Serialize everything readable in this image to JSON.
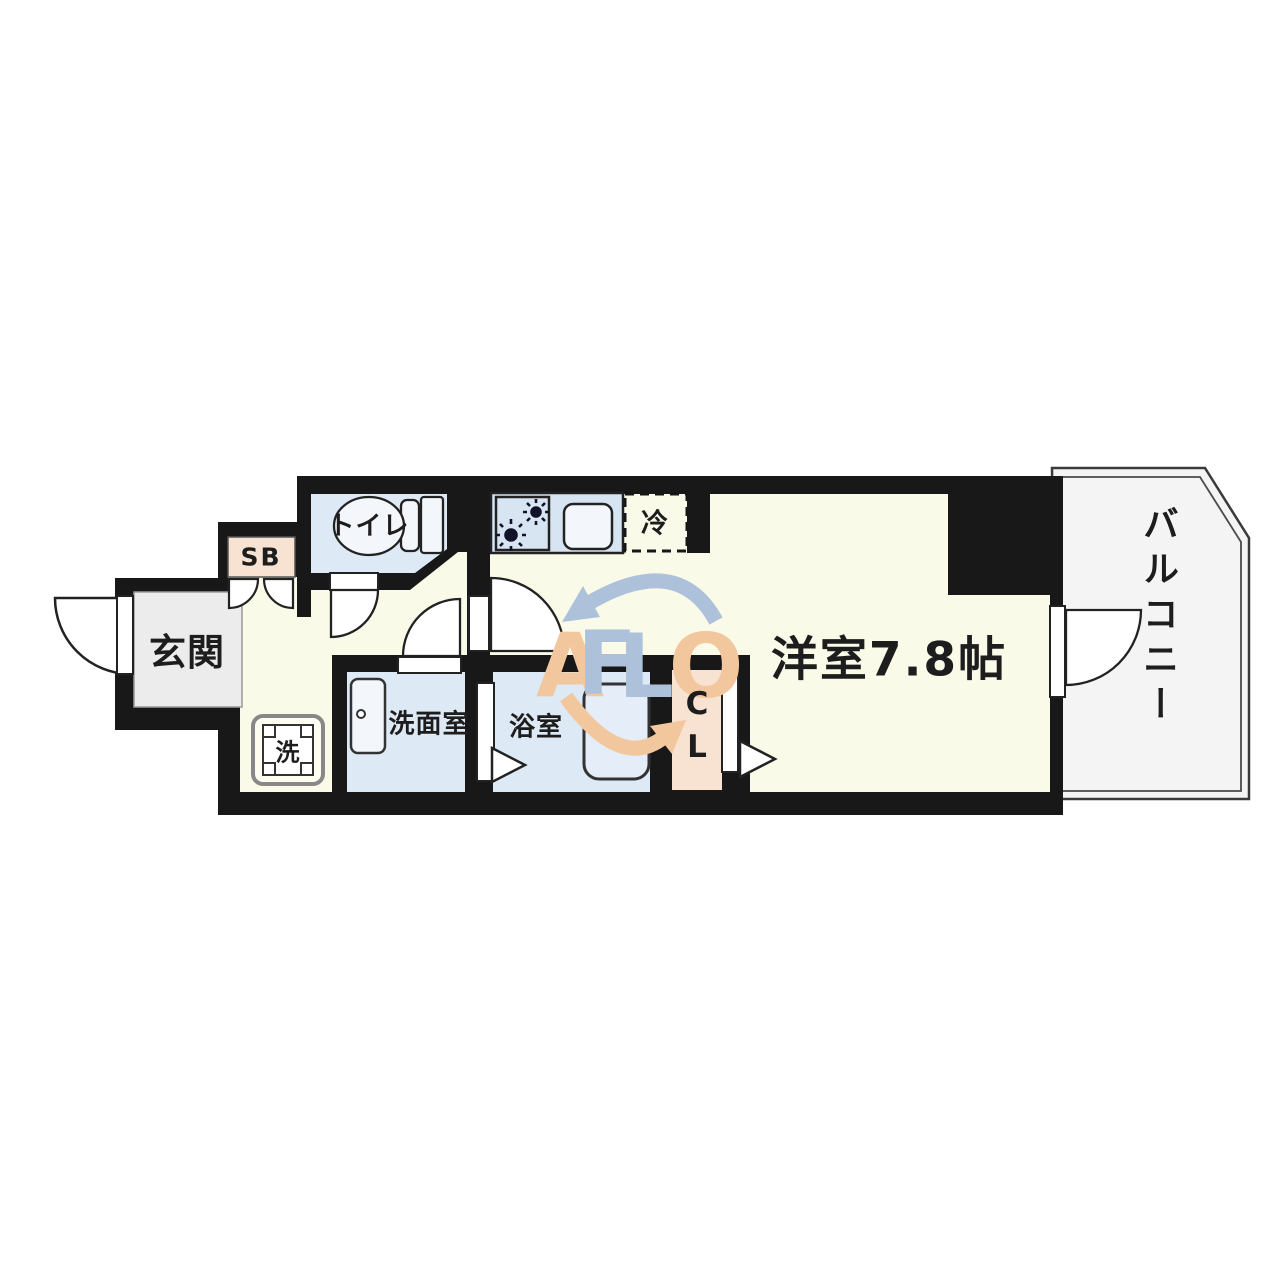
{
  "plan": {
    "rooms": {
      "genkan": "玄関",
      "shoe_box": "SB",
      "toilet": "トイレ",
      "fridge": "冷",
      "washer": "洗",
      "washroom": "洗面室",
      "bathroom": "浴室",
      "closet": "CL",
      "western_room": "洋室7.8帖",
      "balcony": "バルコニー"
    },
    "colors": {
      "wall": "#181818",
      "floor": "#fafae9",
      "wet": "#dde9f4",
      "counter": "#d7e4f2",
      "entry": "#ececec",
      "storage": "#f8e2d2",
      "balcony": "#f4f4f4",
      "fixture": "#f3f7fc",
      "tub": "#e4edf8",
      "white": "#ffffff"
    }
  },
  "watermark": {
    "letters": [
      "A",
      "F",
      "L",
      "O"
    ],
    "blue": "#adc2da",
    "peach": "#f3c79e"
  }
}
